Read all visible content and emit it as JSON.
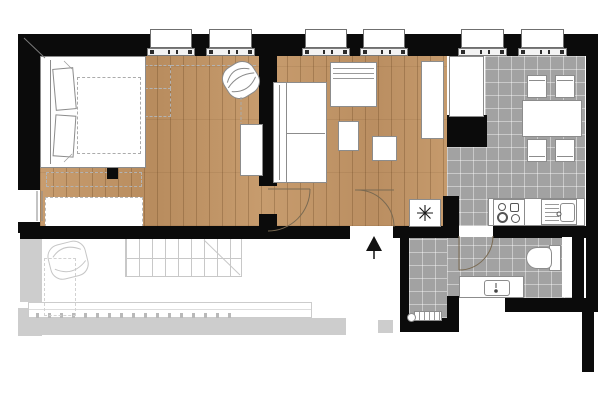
{
  "plan": {
    "title": "studio-apartment-floor-plan",
    "colors": {
      "wall": "#0b0b0b",
      "wood": "#c59a6b",
      "tile": "#a2a2a2",
      "terrace": "#cdcdcd",
      "furniture_line": "#8c8c8c",
      "sketch_line": "#c8c8c8",
      "door_arc": "#7a6a52"
    },
    "rooms": [
      {
        "id": "bedroom",
        "floor": "wood"
      },
      {
        "id": "living-room",
        "floor": "wood"
      },
      {
        "id": "entry-hall",
        "floor": "wood"
      },
      {
        "id": "kitchen-dining",
        "floor": "tile"
      },
      {
        "id": "bathroom",
        "floor": "tile"
      },
      {
        "id": "terrace",
        "floor": "outdoor-sketch"
      }
    ],
    "windows_top": [
      {
        "x": 147,
        "w": 48
      },
      {
        "x": 206,
        "w": 49
      },
      {
        "x": 302,
        "w": 48
      },
      {
        "x": 360,
        "w": 48
      },
      {
        "x": 458,
        "w": 49
      },
      {
        "x": 518,
        "w": 49
      }
    ],
    "window_left": {
      "y": 190,
      "h": 32
    },
    "dining": {
      "table": {
        "w": 60,
        "h": 37
      },
      "chairs": [
        {
          "x": 527,
          "y": 75,
          "back": "top"
        },
        {
          "x": 555,
          "y": 75,
          "back": "top"
        },
        {
          "x": 527,
          "y": 139,
          "back": "bottom"
        },
        {
          "x": 555,
          "y": 139,
          "back": "bottom"
        }
      ]
    },
    "kitchen": {
      "burners": 4,
      "sink": "single-basin-with-drainer"
    },
    "symbols": {
      "water_heater": "8-spoke-asterisk",
      "entrance": "up-arrow"
    },
    "furniture": [
      "double-bed",
      "wardrobe-dashed-outline",
      "round-armchair",
      "side-cabinet",
      "sofa",
      "daybed",
      "side-table",
      "coffee-table",
      "tall-wardrobe",
      "tall-cabinet",
      "kitchen-counter",
      "cooktop",
      "kitchen-sink",
      "dining-table",
      "dining-chair",
      "water-heater",
      "toilet",
      "vanity-sink",
      "radiator",
      "outdoor-chair",
      "outdoor-bench",
      "outdoor-stairs"
    ]
  }
}
